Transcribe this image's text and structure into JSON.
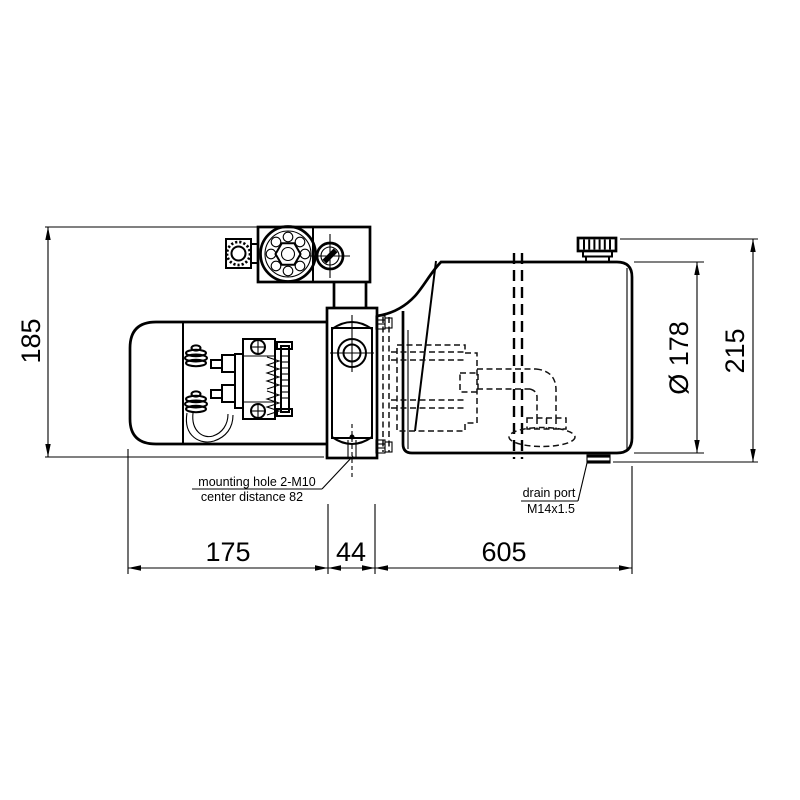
{
  "drawing": {
    "dimensions": {
      "motor_height": "185",
      "motor_length": "175",
      "block_width": "44",
      "tank_length": "605",
      "tank_diameter": "Ø 178",
      "overall_height": "215"
    },
    "annotations": {
      "mounting_hole_line1": "mounting hole 2-M10",
      "mounting_hole_line2": "center distance 82",
      "drain_port_line1": "drain port",
      "drain_port_line2": "M14x1.5"
    },
    "colors": {
      "line": "#000000",
      "background": "#ffffff"
    }
  }
}
